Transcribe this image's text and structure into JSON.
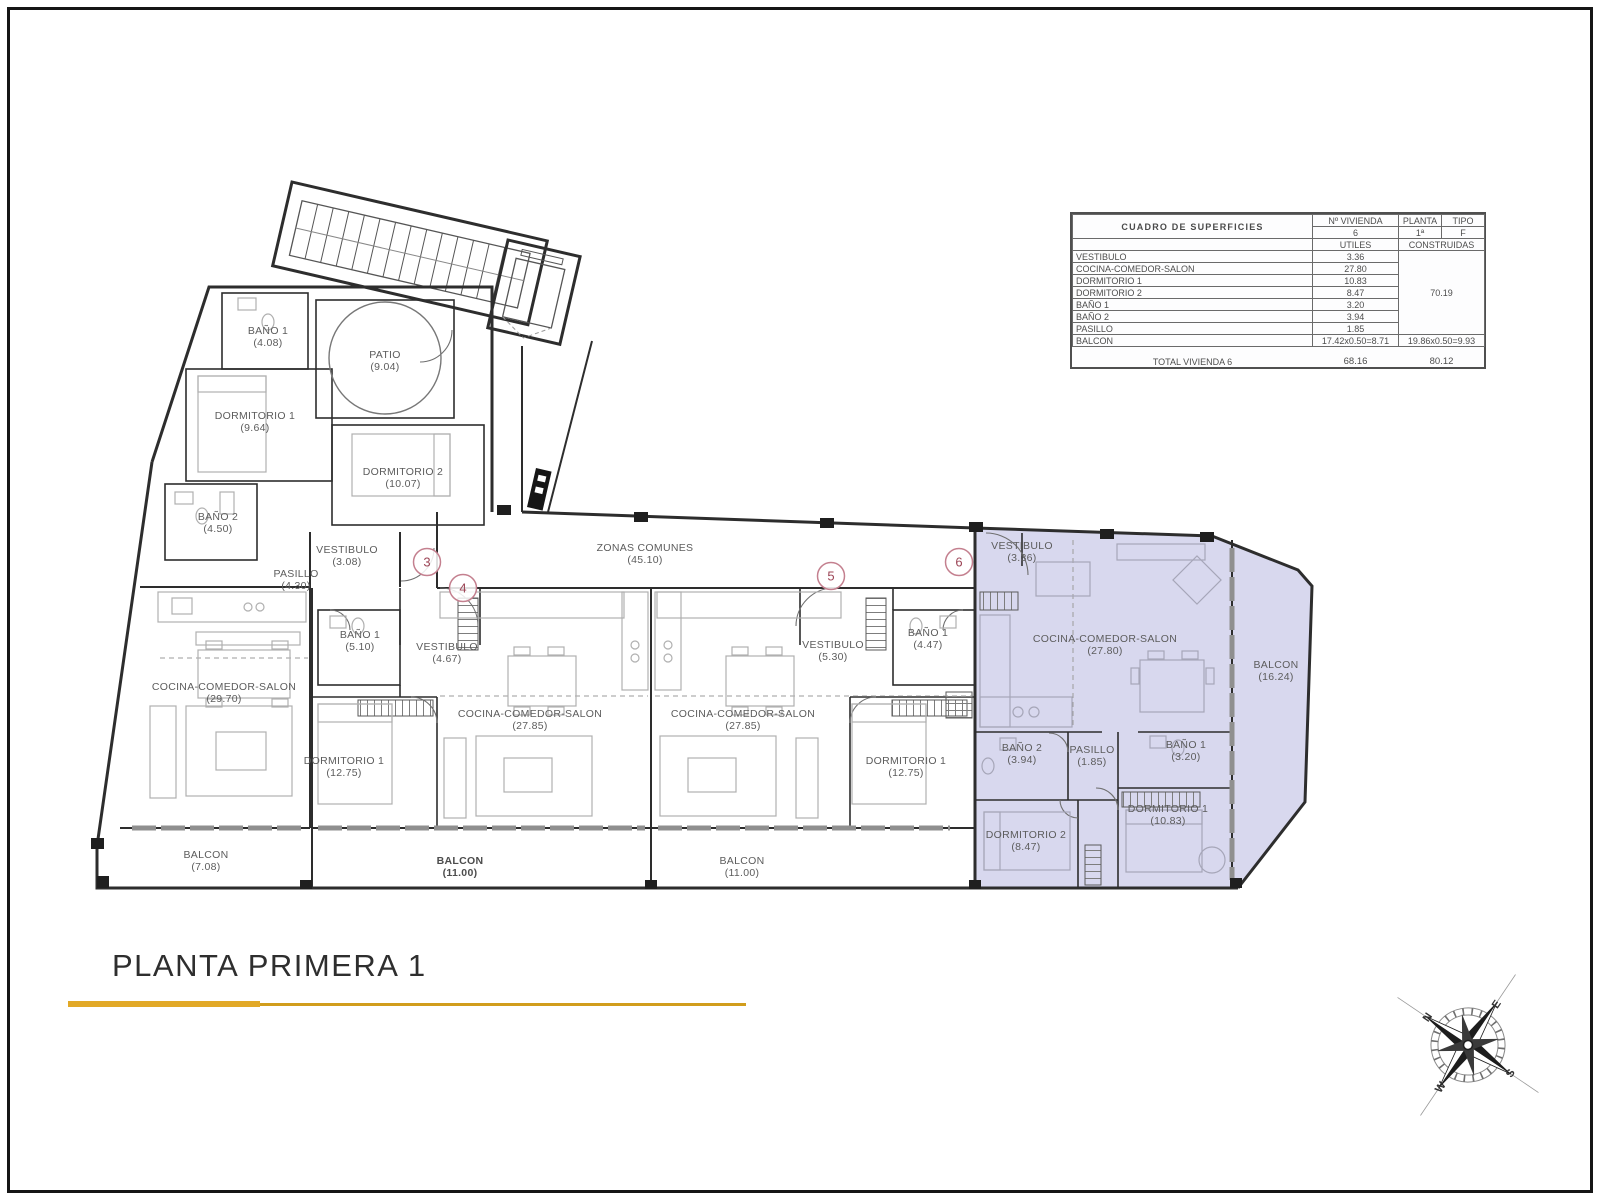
{
  "title_block": {
    "title": "PLANTA PRIMERA 1",
    "underline_color": "#e2a927",
    "underline_color_thin": "#d19d1c"
  },
  "surface_table": {
    "title": "CUADRO DE SUPERFICIES",
    "cols": {
      "vivienda": "Nº VIVIENDA",
      "planta": "PLANTA",
      "tipo": "TIPO",
      "utiles": "UTILES",
      "construidas": "CONSTRUIDAS"
    },
    "unit": {
      "vivienda": "6",
      "planta": "1ª",
      "tipo": "F"
    },
    "rows": [
      {
        "name": "VESTIBULO",
        "utiles": "3.36"
      },
      {
        "name": "COCINA-COMEDOR-SALON",
        "utiles": "27.80"
      },
      {
        "name": "DORMITORIO 1",
        "utiles": "10.83"
      },
      {
        "name": "DORMITORIO 2",
        "utiles": "8.47"
      },
      {
        "name": "BAÑO 1",
        "utiles": "3.20"
      },
      {
        "name": "BAÑO 2",
        "utiles": "3.94"
      },
      {
        "name": "PASILLO",
        "utiles": "1.85"
      }
    ],
    "construidas_partial": "70.19",
    "balcon_row": {
      "name": "BALCON",
      "utiles": "17.42x0.50=8.71",
      "construidas": "19.86x0.50=9.93"
    },
    "total": {
      "label": "TOTAL VIVIENDA 6",
      "utiles": "68.16",
      "construidas": "80.12"
    }
  },
  "plan": {
    "highlight_color": "#d8d8ee",
    "marker_ring_color": "#c4808f",
    "marker_text_color": "#9c4556",
    "rooms": [
      {
        "id": "bano1-apt3",
        "label": "BAÑO 1",
        "area": "(4.08)",
        "x": 268,
        "y": 334
      },
      {
        "id": "patio",
        "label": "PATIO",
        "area": "(9.04)",
        "x": 385,
        "y": 358
      },
      {
        "id": "dorm1-apt3",
        "label": "DORMITORIO 1",
        "area": "(9.64)",
        "x": 255,
        "y": 419
      },
      {
        "id": "dorm2-apt3",
        "label": "DORMITORIO 2",
        "area": "(10.07)",
        "x": 403,
        "y": 475
      },
      {
        "id": "bano2-apt3",
        "label": "BAÑO 2",
        "area": "(4.50)",
        "x": 218,
        "y": 520
      },
      {
        "id": "vest-apt3",
        "label": "VESTIBULO",
        "area": "(3.08)",
        "x": 347,
        "y": 553
      },
      {
        "id": "pasillo-apt3",
        "label": "PASILLO",
        "area": "(4.30)",
        "x": 296,
        "y": 577
      },
      {
        "id": "cocina-apt3",
        "label": "COCINA-COMEDOR-SALON",
        "area": "(29.70)",
        "x": 224,
        "y": 690
      },
      {
        "id": "balcon-apt3",
        "label": "BALCON",
        "area": "(7.08)",
        "x": 206,
        "y": 858
      },
      {
        "id": "zonas-comunes",
        "label": "ZONAS COMUNES",
        "area": "(45.10)",
        "x": 645,
        "y": 551
      },
      {
        "id": "bano1-apt4",
        "label": "BAÑO 1",
        "area": "(5.10)",
        "x": 360,
        "y": 638
      },
      {
        "id": "vest-apt4",
        "label": "VESTIBULO",
        "area": "(4.67)",
        "x": 447,
        "y": 650
      },
      {
        "id": "cocina-apt4",
        "label": "COCINA-COMEDOR-SALON",
        "area": "(27.85)",
        "x": 530,
        "y": 717
      },
      {
        "id": "dorm1-apt4",
        "label": "DORMITORIO 1",
        "area": "(12.75)",
        "x": 344,
        "y": 764
      },
      {
        "id": "balcon-apt4",
        "label": "BALCON",
        "area": "(11.00)",
        "x": 460,
        "y": 864,
        "bold": true
      },
      {
        "id": "cocina-apt5",
        "label": "COCINA-COMEDOR-SALON",
        "area": "(27.85)",
        "x": 743,
        "y": 717
      },
      {
        "id": "vest-apt5",
        "label": "VESTIBULO",
        "area": "(5.30)",
        "x": 833,
        "y": 648
      },
      {
        "id": "bano1-apt5",
        "label": "BAÑO 1",
        "area": "(4.47)",
        "x": 928,
        "y": 636
      },
      {
        "id": "dorm1-apt5",
        "label": "DORMITORIO 1",
        "area": "(12.75)",
        "x": 906,
        "y": 764
      },
      {
        "id": "balcon-apt5",
        "label": "BALCON",
        "area": "(11.00)",
        "x": 742,
        "y": 864
      },
      {
        "id": "vest-apt6",
        "label": "VESTIBULO",
        "area": "(3.36)",
        "x": 1022,
        "y": 549
      },
      {
        "id": "cocina-apt6",
        "label": "COCINA-COMEDOR-SALON",
        "area": "(27.80)",
        "x": 1105,
        "y": 642
      },
      {
        "id": "balcon-apt6",
        "label": "BALCON",
        "area": "(16.24)",
        "x": 1276,
        "y": 668
      },
      {
        "id": "bano2-apt6",
        "label": "BAÑO 2",
        "area": "(3.94)",
        "x": 1022,
        "y": 751
      },
      {
        "id": "pasillo-apt6",
        "label": "PASILLO",
        "area": "(1.85)",
        "x": 1092,
        "y": 753
      },
      {
        "id": "bano1-apt6",
        "label": "BAÑO 1",
        "area": "(3.20)",
        "x": 1186,
        "y": 748
      },
      {
        "id": "dorm2-apt6",
        "label": "DORMITORIO 2",
        "area": "(8.47)",
        "x": 1026,
        "y": 838
      },
      {
        "id": "dorm1-apt6",
        "label": "DORMITORIO 1",
        "area": "(10.83)",
        "x": 1168,
        "y": 812
      }
    ],
    "unit_markers": [
      {
        "label": "3",
        "x": 427,
        "y": 562
      },
      {
        "label": "4",
        "x": 463,
        "y": 588
      },
      {
        "label": "5",
        "x": 831,
        "y": 576
      },
      {
        "label": "6",
        "x": 959,
        "y": 562
      }
    ]
  },
  "compass": {
    "north": "N",
    "east": "E",
    "south": "S",
    "west": "W",
    "north_color": "#b5382c"
  }
}
